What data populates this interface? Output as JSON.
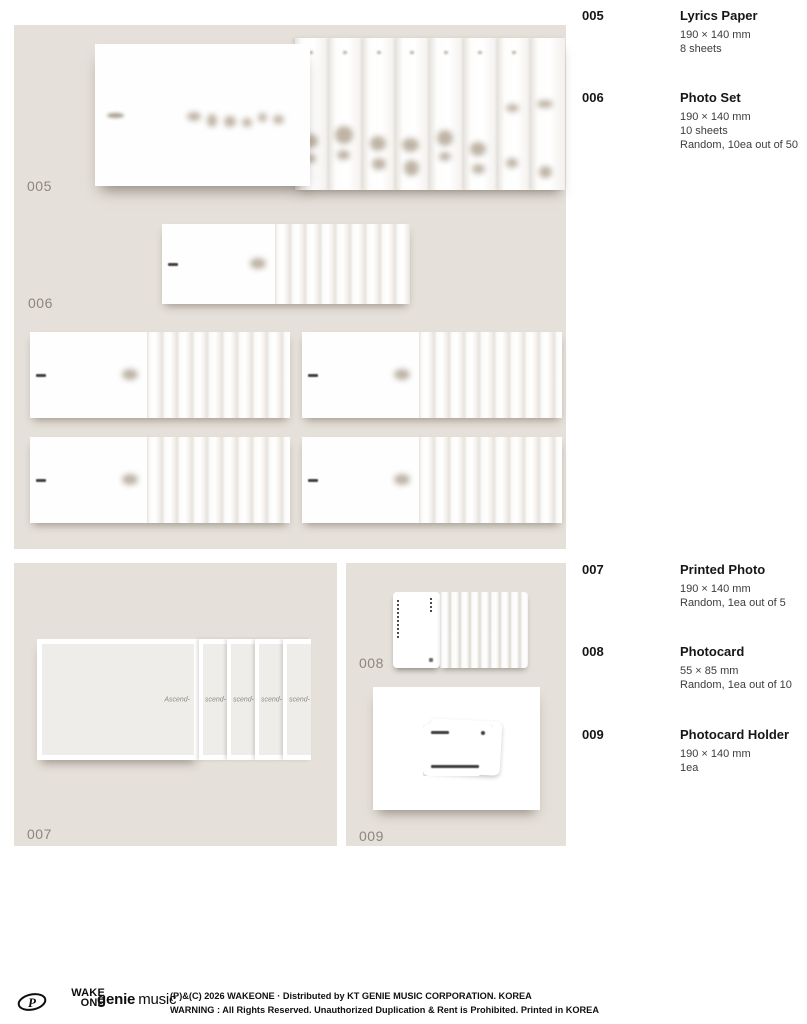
{
  "items": [
    {
      "number": "005",
      "title": "Lyrics Paper",
      "details": [
        "190 × 140 mm",
        "8 sheets"
      ]
    },
    {
      "number": "006",
      "title": "Photo Set",
      "details": [
        "190 × 140 mm",
        "10 sheets",
        "Random, 10ea out of 50"
      ]
    },
    {
      "number": "007",
      "title": "Printed Photo",
      "details": [
        "190 × 140 mm",
        "Random, 1ea out of 5"
      ]
    },
    {
      "number": "008",
      "title": "Photocard",
      "details": [
        "55 × 85 mm",
        "Random, 1ea out of 10"
      ]
    },
    {
      "number": "009",
      "title": "Photocard Holder",
      "details": [
        "190 × 140 mm",
        "1ea"
      ]
    }
  ],
  "printed_photo": {
    "front_text": "Ascend-",
    "strip_text": "scend-"
  },
  "footer": {
    "monogram_letter": "P",
    "wakeone_top": "WAKE",
    "wakeone_bottom": "ONE",
    "genie_word1": "genie",
    "genie_word2": "music",
    "line1": "(P)&(C) 2026 WAKEONE · Distributed by KT GENIE MUSIC CORPORATION. KOREA",
    "line2": "WARNING : All Rights Reserved. Unauthorized Duplication & Rent is Prohibited. Printed in KOREA"
  },
  "colors": {
    "panel": "#e5e0d9",
    "figure_label": "#8c867d",
    "page_bg": "#ffffff"
  }
}
